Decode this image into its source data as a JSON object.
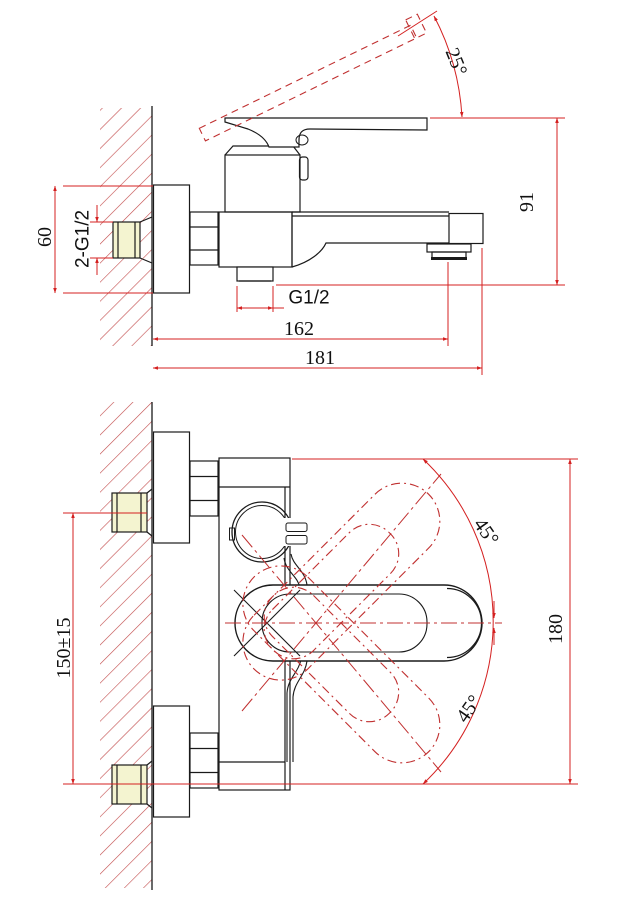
{
  "drawing": {
    "kind": "installation dimension drawing",
    "product": "wall-mounted single-lever bath mixer",
    "views": {
      "side": {
        "name": "side view",
        "labels": {
          "handle_open_angle": "25°",
          "overall_height": "91",
          "escutcheon_height": "60",
          "inlet_connections": "2-G1/2",
          "shower_outlet_thread": "G1/2",
          "spout_reach": "162",
          "overall_reach": "181"
        }
      },
      "front": {
        "name": "front view",
        "labels": {
          "handle_swing_upper": "45°",
          "handle_swing_lower": "45°",
          "handle_swing_envelope": "180",
          "inlet_center_distance": "150±15"
        }
      }
    },
    "colors": {
      "lines": "#1a1a1a",
      "dimensions": "#d42020",
      "hatch": "#c24b4b",
      "phantom": "#c03030",
      "connector_fill": "#f4f4d0"
    }
  }
}
